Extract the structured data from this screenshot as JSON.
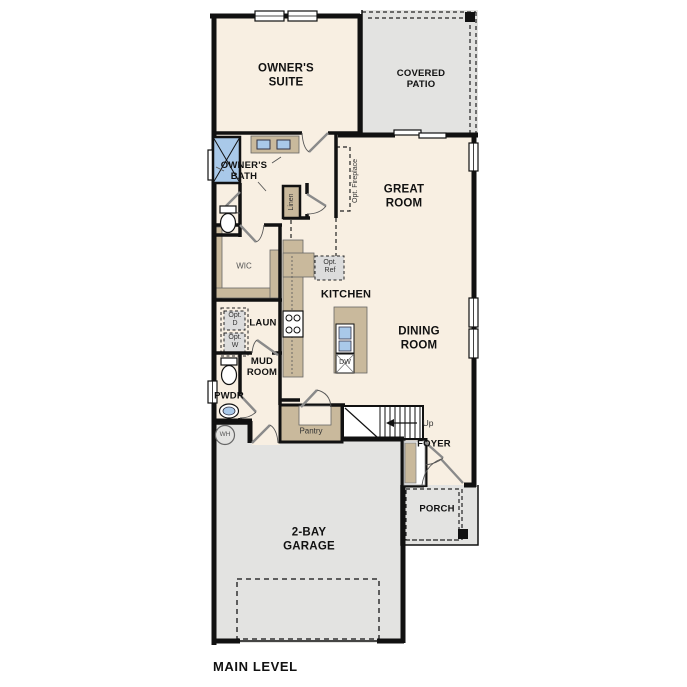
{
  "plan_title": "MAIN LEVEL",
  "rooms": {
    "owners_suite": "OWNER'S SUITE",
    "covered_patio": "COVERED PATIO",
    "owners_bath": "OWNER'S BATH",
    "great_room": "GREAT ROOM",
    "wic": "WIC",
    "kitchen": "KITCHEN",
    "laundry": "LAUN",
    "mud_room": "MUD ROOM",
    "dining_room": "DINING ROOM",
    "pwdr": "PWDR",
    "pantry": "Pantry",
    "foyer": "FOYER",
    "porch": "PORCH",
    "garage": "2-BAY GARAGE"
  },
  "annotations": {
    "opt_fireplace": "Opt. Fireplace",
    "opt_ref": "Opt. Ref",
    "opt_dryer": "Opt. D",
    "opt_washer": "Opt. W",
    "linen": "Linen",
    "water_heater": "WH",
    "dishwasher": "DW",
    "stairs_up": "Up"
  },
  "colors": {
    "wall": "#111111",
    "floor": "#f8efe2",
    "outdoor": "#e3e3e1",
    "cabinet": "#c9b99c",
    "fixture_blue": "#a9c9e9",
    "optional_gray": "#dcdcdc"
  }
}
